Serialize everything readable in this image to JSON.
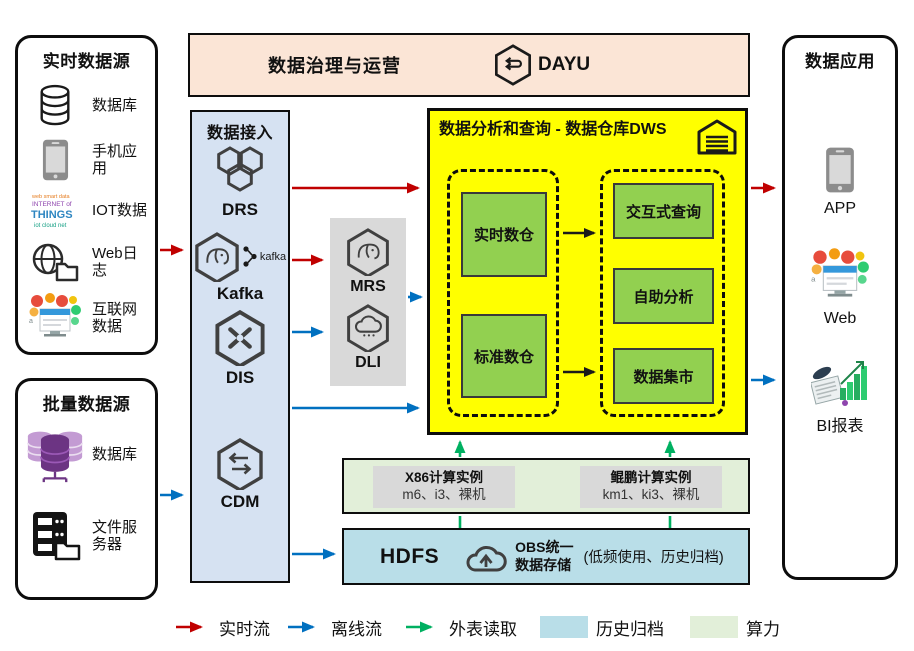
{
  "colors": {
    "realtime_arrow": "#C00000",
    "offline_arrow": "#0070C0",
    "external_read_arrow": "#00B061",
    "archive_fill": "#B9DEE8",
    "compute_fill": "#E2EFD9",
    "governance_fill": "#FBE5D6",
    "ingestion_fill": "#D6E2F2",
    "dws_fill": "#FFFF00",
    "dws_cell_fill": "#92D050",
    "gray_fill": "#D9D9D9"
  },
  "realtime_sources": {
    "title": "实时数据源",
    "items": [
      {
        "icon": "database-icon",
        "label": "数据库"
      },
      {
        "icon": "mobile-icon",
        "label": "手机应用"
      },
      {
        "icon": "iot-icon",
        "label": "IOT数据"
      },
      {
        "icon": "weblog-icon",
        "label": "Web日志"
      },
      {
        "icon": "internet-icon",
        "label": "互联网数据"
      }
    ]
  },
  "batch_sources": {
    "title": "批量数据源",
    "items": [
      {
        "icon": "database-cluster-icon",
        "label": "数据库"
      },
      {
        "icon": "file-server-icon",
        "label": "文件服务器"
      }
    ]
  },
  "governance": {
    "title": "数据治理与运营",
    "product": "DAYU"
  },
  "ingestion": {
    "title": "数据接入",
    "services": [
      {
        "name": "DRS"
      },
      {
        "name": "Kafka",
        "logo_text": "kafka"
      },
      {
        "name": "DIS"
      },
      {
        "name": "CDM"
      }
    ]
  },
  "processing": {
    "services": [
      {
        "name": "MRS"
      },
      {
        "name": "DLI"
      }
    ]
  },
  "dws": {
    "title": "数据分析和查询 - 数据仓库DWS",
    "warehouses": [
      {
        "label": "实时数仓"
      },
      {
        "label": "标准数仓"
      }
    ],
    "analytics": [
      {
        "label": "交互式查询"
      },
      {
        "label": "自助分析"
      },
      {
        "label": "数据集市"
      }
    ]
  },
  "compute": {
    "instances": [
      {
        "title": "X86计算实例",
        "specs": "m6、i3、裸机"
      },
      {
        "title": "鲲鹏计算实例",
        "specs": "km1、ki3、裸机"
      }
    ]
  },
  "storage": {
    "hdfs": "HDFS",
    "obs_line1": "OBS统一",
    "obs_line2": "数据存储",
    "note": "(低频使用、历史归档)"
  },
  "applications": {
    "title": "数据应用",
    "items": [
      {
        "icon": "app-icon",
        "label": "APP"
      },
      {
        "icon": "web-icon",
        "label": "Web"
      },
      {
        "icon": "bi-icon",
        "label": "BI报表"
      }
    ]
  },
  "legend": {
    "items": [
      {
        "type": "arrow",
        "color": "#C00000",
        "label": "实时流"
      },
      {
        "type": "arrow",
        "color": "#0070C0",
        "label": "离线流"
      },
      {
        "type": "arrow",
        "color": "#00B061",
        "label": "外表读取"
      },
      {
        "type": "swatch",
        "color": "#B9DEE8",
        "label": "历史归档"
      },
      {
        "type": "swatch",
        "color": "#E2EFD9",
        "label": "算力"
      }
    ]
  }
}
